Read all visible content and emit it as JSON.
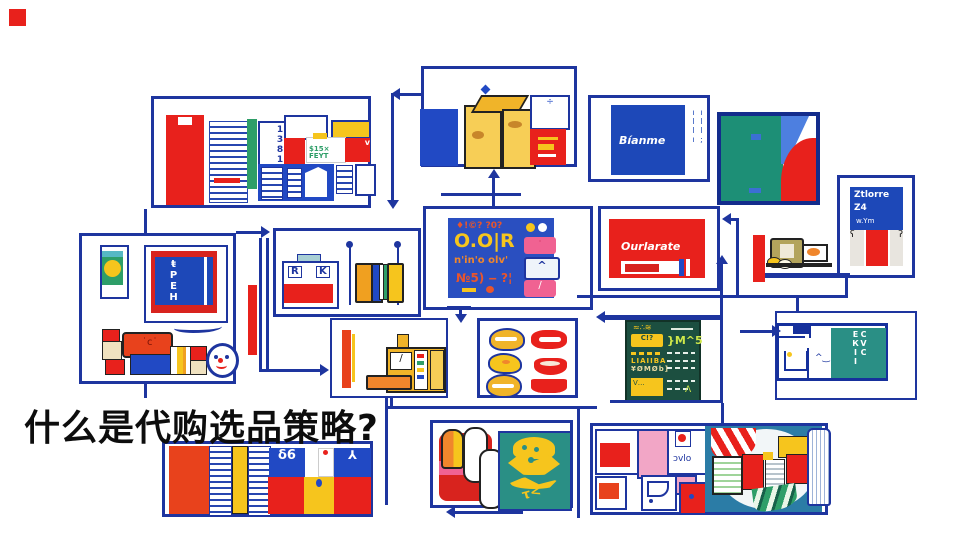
{
  "headline": {
    "text": "什么是代购选品策略?"
  },
  "colors": {
    "ink": "#1e359f",
    "red": "#e8211c",
    "yellow": "#f6c51d",
    "teal": "#1d8f76",
    "menu_green": "#1c4f40",
    "steel_blue": "#2b7ca6",
    "royal": "#2149c4",
    "pink": "#f2a6c6"
  },
  "box1": {
    "card_code": "1381",
    "price_tag": "$15× FEYT",
    "tag_mark": "v"
  },
  "box3": {
    "sign": "Bíanme",
    "side_marks": "ıll; ıllı"
  },
  "box5": {
    "line1": "Ztlorre",
    "line2": "Z4",
    "line3": "w.Ym"
  },
  "box6": {
    "frame_code": "ŧPEH"
  },
  "box7": {
    "glyph_left": "R",
    "glyph_right": "K"
  },
  "box8": {
    "row1": "♦!©? ?0?",
    "big": "O.O|R",
    "row3": "n'in'o olv'",
    "row4": "№5) ‒ ?¦",
    "key_up": "^",
    "key_slash": "/",
    "key_dot": "·"
  },
  "box9": {
    "brand": "Ourlarate"
  },
  "box13": {
    "scribble": "≈∴≋",
    "label": "C!?",
    "glyph": "}M^5",
    "rows1": "LIAIIBA",
    "rows2": "¥ØMØb]",
    "block": "V…"
  },
  "box14": {
    "vtext": "CVC ЕКІІ"
  },
  "box15": {
    "glyph_left": "δ6",
    "glyph_right": "⅄"
  },
  "box16": {
    "emblem_mark": "τ<"
  },
  "box17": {
    "script": "ɔvlo"
  }
}
